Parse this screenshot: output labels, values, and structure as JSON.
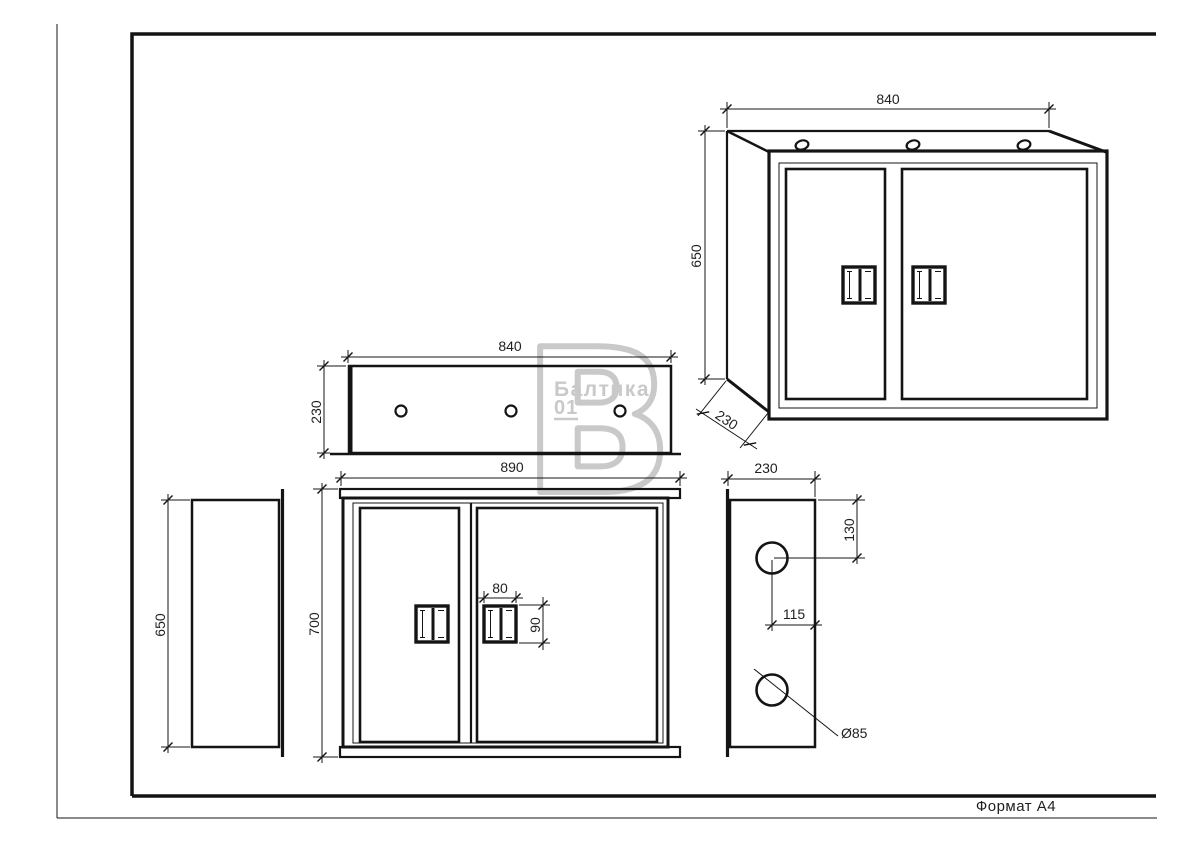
{
  "stamp": {
    "format_label": "Формат А4"
  },
  "watermark": {
    "brand": "Балтика",
    "number": "01",
    "monogram": "В"
  },
  "dimensions": {
    "perspective": {
      "width": "840",
      "height": "650",
      "depth": "230"
    },
    "top_view": {
      "width": "840",
      "depth": "230"
    },
    "front_view": {
      "overall_width": "890",
      "overall_height": "700",
      "handle_width": "80",
      "handle_height": "90"
    },
    "left_view": {
      "height": "650"
    },
    "right_view": {
      "width": "230",
      "hole_top_offset": "130",
      "hole_side_offset": "115",
      "hole_diameter": "Ø85"
    }
  },
  "colors": {
    "line": "#141414",
    "text": "#1f1f1f",
    "watermark": "#c9c9c9",
    "background": "#ffffff"
  }
}
